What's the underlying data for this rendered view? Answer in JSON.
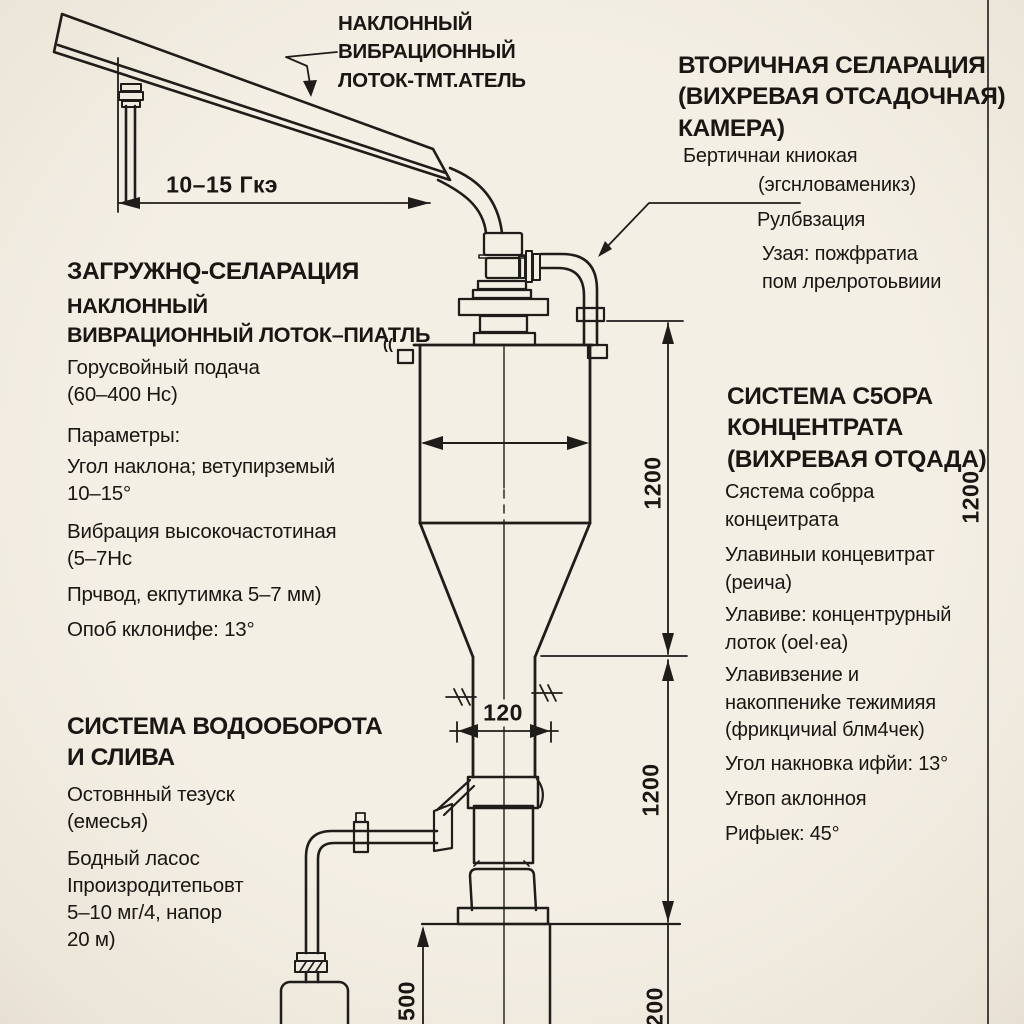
{
  "colors": {
    "paper": "#f3eee4",
    "ink": "#1f1d1a",
    "text": "#191613"
  },
  "labels": {
    "feeder_callout": "НАКЛОННЫЙ\nВИБРАЦИОННЫЙ\nЛОТОК-ТМТ.АТЕЛЬ",
    "secondary_title": "ВТОРИЧНАЯ СЕЛАРАЦИЯ\n(ВИХРЕВАЯ ОТСАДОЧНАЯ)\nКАМЕРА)",
    "secondary_p1": "Бертичнаи книокая",
    "secondary_p2": "(эгснловаменикз)",
    "secondary_p3": "Рулбвзация",
    "secondary_p4": "Узая: пожфратиа\nпом лрелротоьвиии",
    "loading_title": "ЗАГРУЖНQ-СЕЛАРАЦИЯ",
    "loading_sub": "НАКЛОННЫЙ\nВИВРАЦИОННЫЙ ЛОТОК–ПИАТЛЬ",
    "loading_p1": "Горусвойный подача\n(60–400 Нс)",
    "loading_p2": "Параметры:",
    "loading_p3": "Угол наклона; ветупирземый\n10–15°",
    "loading_p4": "Вибрация высокочастотиная\n(5–7Нс",
    "loading_p5": "Прчвод, екпутимка 5–7 мм)",
    "loading_p6": "Опоб кклонифе: 13°",
    "collect_title": "СИСТЕМА С5ОРА\nКОНЦЕНТРАТА\n(ВИХРЕВАЯ ОТQАДА)",
    "collect_p1": "Сястема собрра\nконцеитрата",
    "collect_p2": "Улавиныи концевитрат\n(реича)",
    "collect_p3": "Улавиве: концентрурный\nлоток (oel·ea)",
    "collect_p4": "Улавивзение и\nнакоппениkе тежимияя\n(фрикцичиаl блм4чек)",
    "collect_p5": "Угол накновка ифйи: 13°",
    "collect_p6": "Угвоп аклонноя",
    "collect_p7": "Рифыек: 45°",
    "water_title": "СИСТЕМА ВОДООБОРОТА\nИ СЛИВА",
    "water_p1": "Остовнный тезуск\n(емесья)",
    "water_p2": "Бодный ласос\nIпроизродитепьовт\n5–10 мг/4, напор\n20 м)",
    "corner_mark": "(("
  },
  "dimensions": {
    "feeder_span": "10–15 Гкэ",
    "throat_width": "120",
    "height_upper": "1200",
    "height_lower": "1200",
    "height_right": "1200",
    "base_height": "500",
    "base_offset": "200"
  }
}
